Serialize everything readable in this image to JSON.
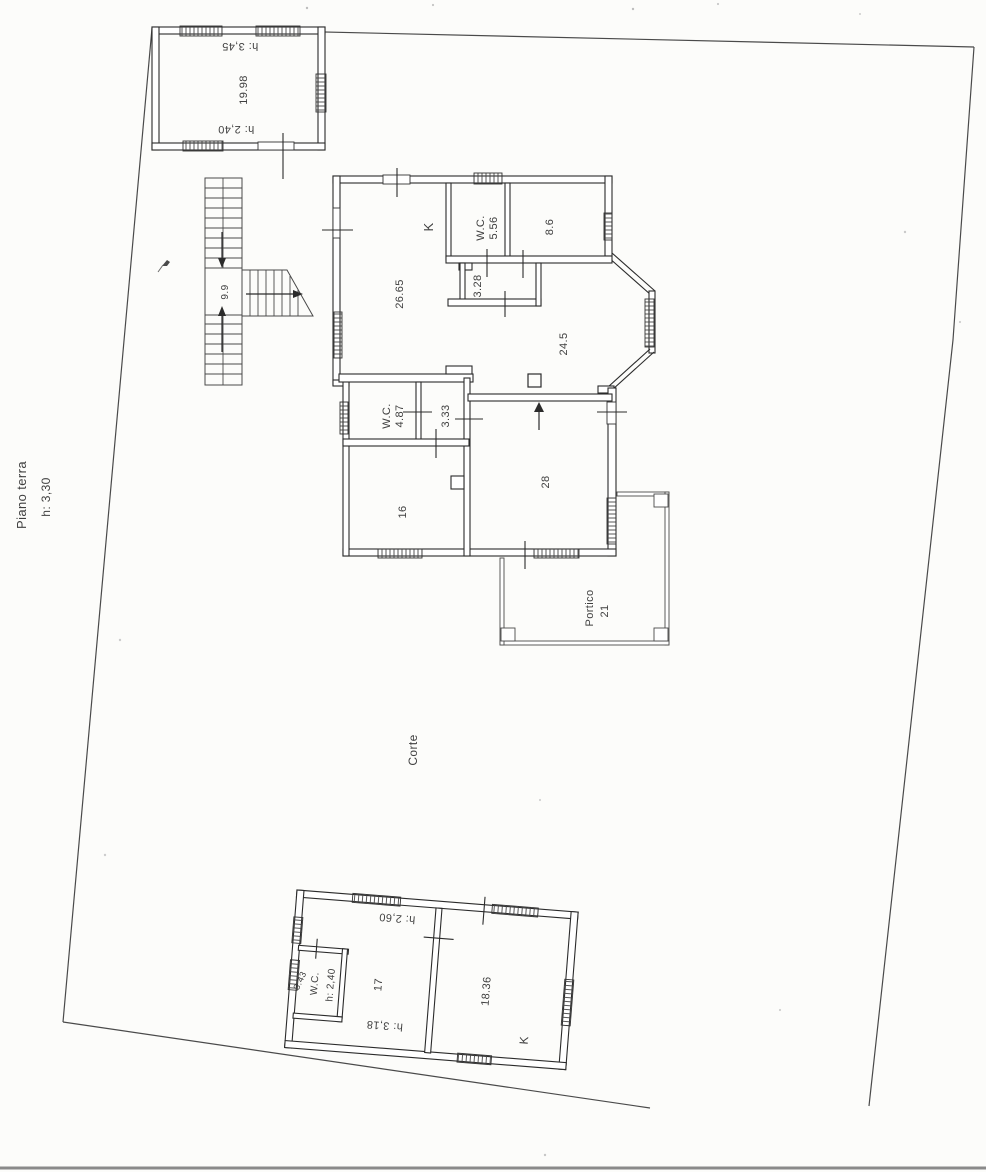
{
  "plan": {
    "floor_label": "Piano terra",
    "floor_height": "h: 3,30",
    "courtyard_label": "Corte"
  },
  "annex_top": {
    "area": "19.98",
    "height_front": "h: 3,45",
    "height_back": "h: 2,40"
  },
  "staircase": {
    "landing_area": "9.9"
  },
  "main_house": {
    "kitchen_label": "K",
    "wc_label": "W.C.",
    "wc_area": "5.56",
    "room86_area": "8.6",
    "living_area": "26.65",
    "hall_area": "3.28",
    "dining_area": "24.5",
    "wc2_label": "W.C.",
    "wc2_area": "4.87",
    "hall2_area": "3.33",
    "room16_area": "16",
    "room28_area": "28"
  },
  "portico": {
    "label": "Portico",
    "area": "21"
  },
  "annex_bottom": {
    "height_front": "h: 2,60",
    "room17_area": "17",
    "height_back": "h: 3,18",
    "wc_label": "W.C.",
    "wc_height": "h: 2,40",
    "wc_area": "3.43",
    "room1836_area": "18.36",
    "kitchen_label": "K"
  },
  "colors": {
    "wall": "#2b2b2b",
    "boundary_line": "#4a4a4a",
    "paper": "#fcfcfa",
    "text": "#3f3f3f"
  }
}
